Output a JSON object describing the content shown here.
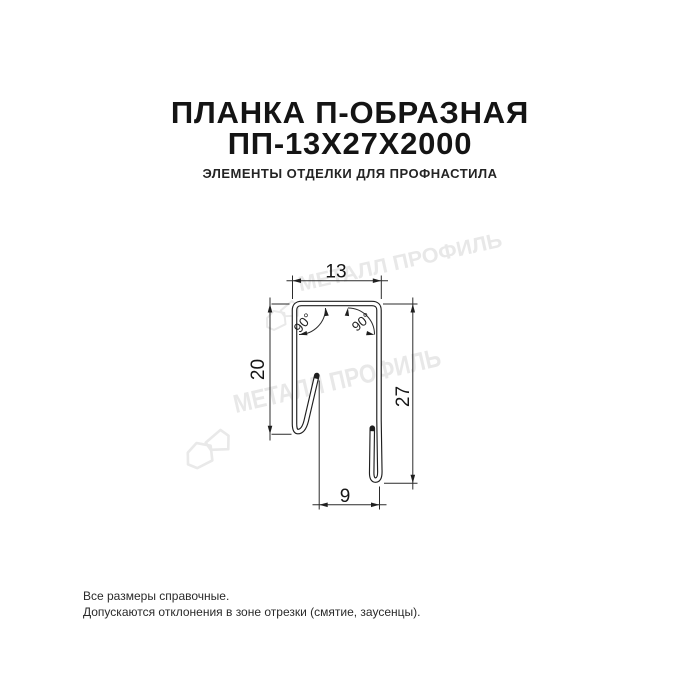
{
  "header": {
    "title_line1": "ПЛАНКА П-ОБРАЗНАЯ",
    "title_line2": "ПП-13Х27Х2000",
    "subtitle": "ЭЛЕМЕНТЫ ОТДЕЛКИ ДЛЯ ПРОФНАСТИЛА"
  },
  "drawing": {
    "type": "technical cross-section of U-shaped metal strip",
    "dimensions": {
      "top_width": "13",
      "left_height": "20",
      "right_height": "27",
      "bottom_width": "9"
    },
    "angles": {
      "left": "90°",
      "right": "90°"
    }
  },
  "watermark": {
    "text": "МЕТАЛЛ ПРОФИЛЬ",
    "color": "#e8e8e8"
  },
  "footer": {
    "line1": "Все размеры справочные.",
    "line2": "Допускаются отклонения в зоне отрезки (смятие, заусенцы)."
  },
  "colors": {
    "background": "#ffffff",
    "title_text": "#141414",
    "drawing_line": "#1f1f1f",
    "watermark": "#e8e8e8"
  }
}
